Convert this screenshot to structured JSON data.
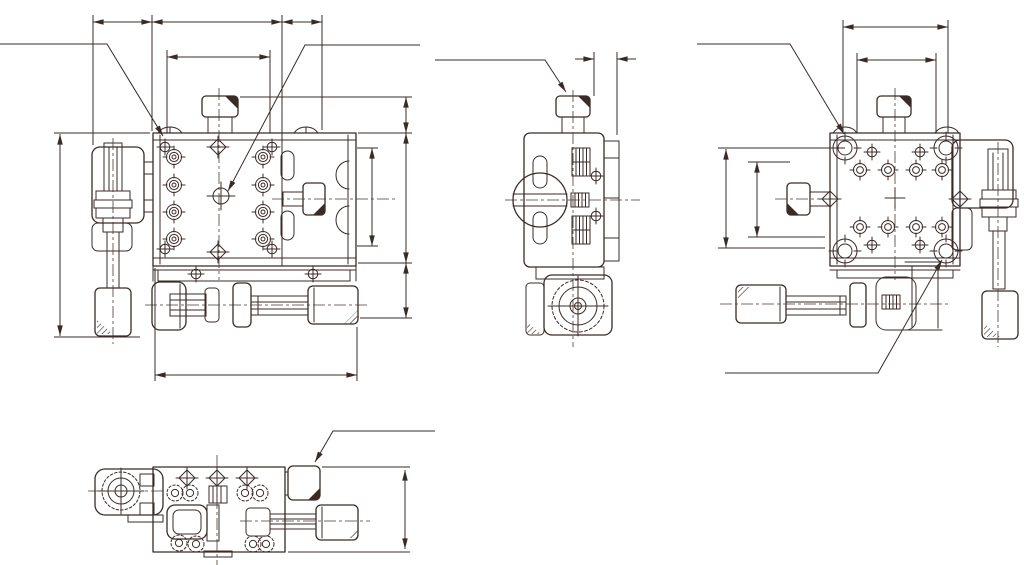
{
  "page": {
    "background_color": "#ffffff"
  },
  "drawing": {
    "stroke_color": "#3a2b27",
    "centerline_color": "#4a3a34",
    "text_labels": [],
    "views": [
      {
        "id": "front-view",
        "position": "top-left",
        "description": "front elevation: stage body, left clamp handle, bottom micrometer, side knob"
      },
      {
        "id": "side-view",
        "position": "top-center",
        "description": "side elevation: handle end-on, knurled nuts, micrometer thimble end"
      },
      {
        "id": "rear-view",
        "position": "top-right",
        "description": "rear elevation: corner clamps, right handle, left-pointing micrometer"
      },
      {
        "id": "top-view",
        "position": "bottom-left",
        "description": "plan view: knob circle, knurled nuts, micrometer to the right"
      }
    ],
    "dimension_segments": 16,
    "leader_arrows": 6
  }
}
